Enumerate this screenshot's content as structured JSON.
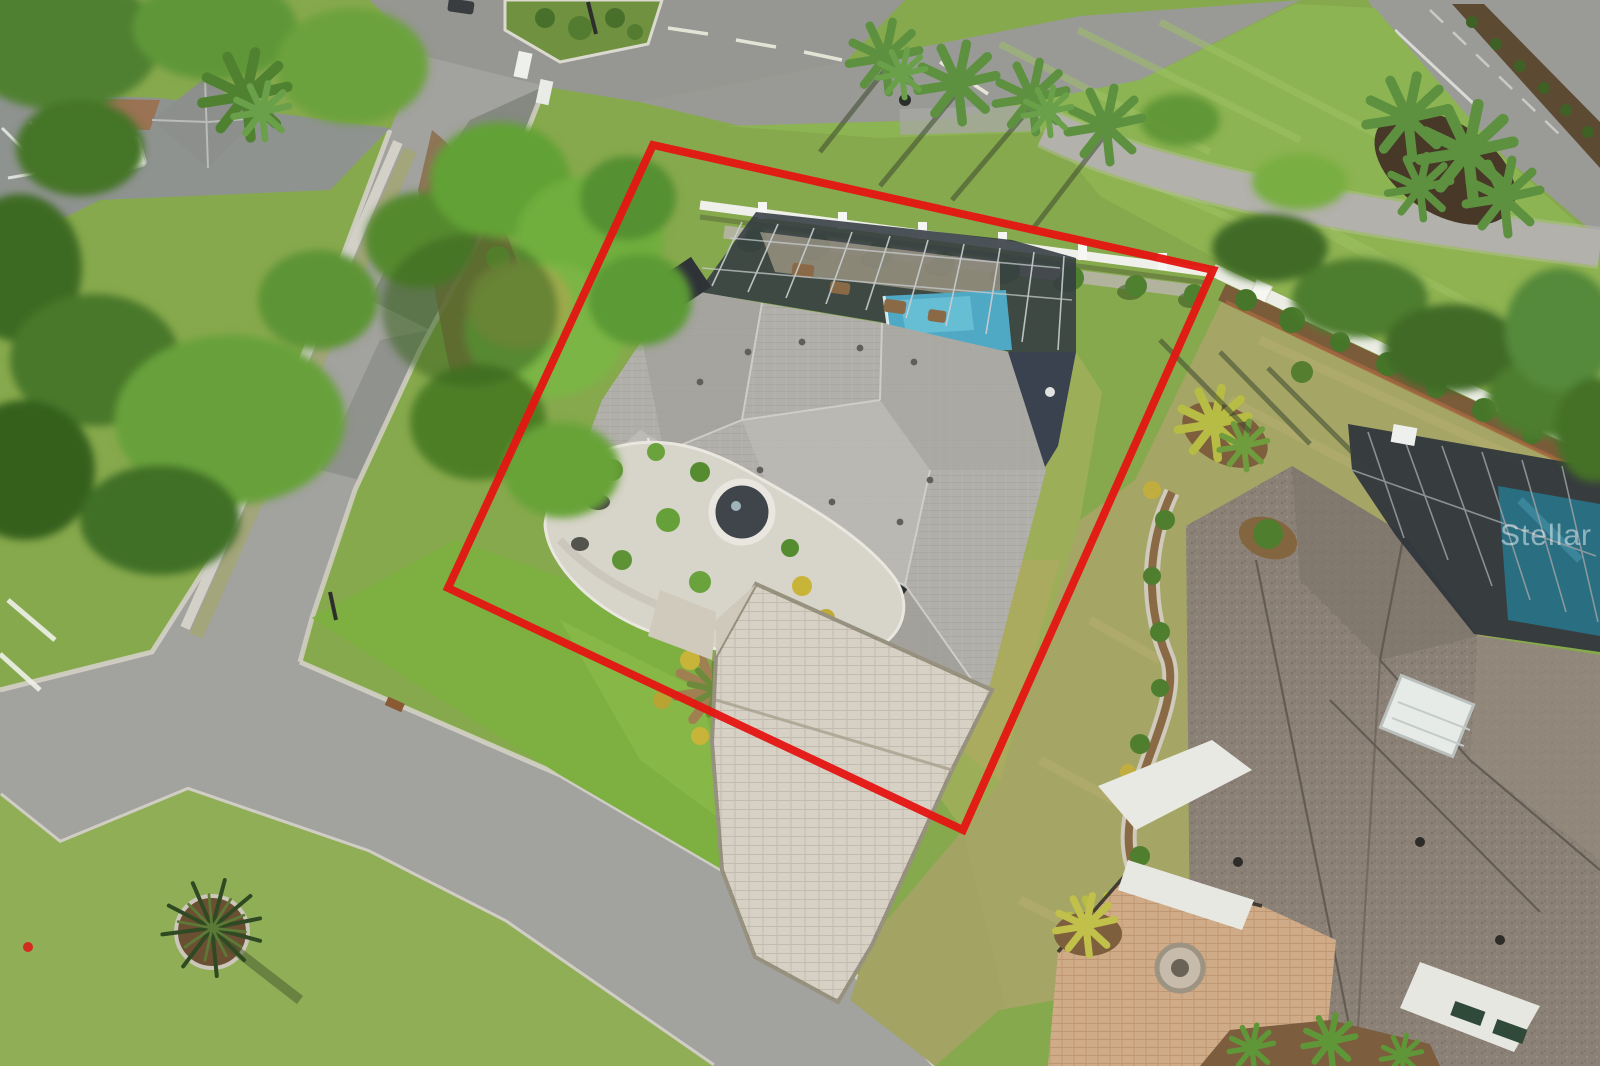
{
  "meta": {
    "type": "aerial-drone-photograph",
    "subject": "Overhead real-estate photo of a single-family home with screened pool, paver driveway and a red property-boundary outline",
    "dimensions": {
      "width": 1600,
      "height": 1066
    }
  },
  "watermark": {
    "text": "Stellar"
  },
  "boundary": {
    "color": "#e41713",
    "stroke_width": 8,
    "corners": [
      {
        "x": 653,
        "y": 145
      },
      {
        "x": 1213,
        "y": 270
      },
      {
        "x": 963,
        "y": 830
      },
      {
        "x": 448,
        "y": 588
      }
    ]
  },
  "palette": {
    "grass": "#87a94d",
    "bright_lawn": "#8db452",
    "dry_lawn": "#a8a566",
    "road": "#9d9d99",
    "curb": "#d3d0c6",
    "sidewalk": "#d6d3ca",
    "roof_main": "#b1afaa",
    "roof_neighbor": "#8b8176",
    "pool_water": "#4fa9c5",
    "pool_screen": "#343b42",
    "screen_frame": "#c9ced0",
    "driveway_pavers": "#d7d1c5",
    "neighbor_pavers": "#d0ab87",
    "white_fence": "#eff0ea",
    "mulch": "#7c5e3e",
    "rock_garden": "#d7d4ca",
    "tree_dark": "#3f6a26",
    "tree_light": "#6fae3e",
    "palm_green": "#5d9140",
    "hydrant_red": "#d22b20"
  },
  "features": [
    "red property boundary outline",
    "gray hip roof of main house",
    "screened pool enclosure with blue pool",
    "white vinyl fence and white privacy wall with shrubs",
    "paver driveway and front rock garden with round fountain",
    "curving streets with curbs and grass verges",
    "parking lot with striped stalls and small pavilion",
    "palm trees and oak canopy",
    "neighboring house with dark shingle roof, skylight and tan paver courtyard",
    "golf-cart path through lawn",
    "mulch island with yucca plant",
    "fire hydrant"
  ]
}
